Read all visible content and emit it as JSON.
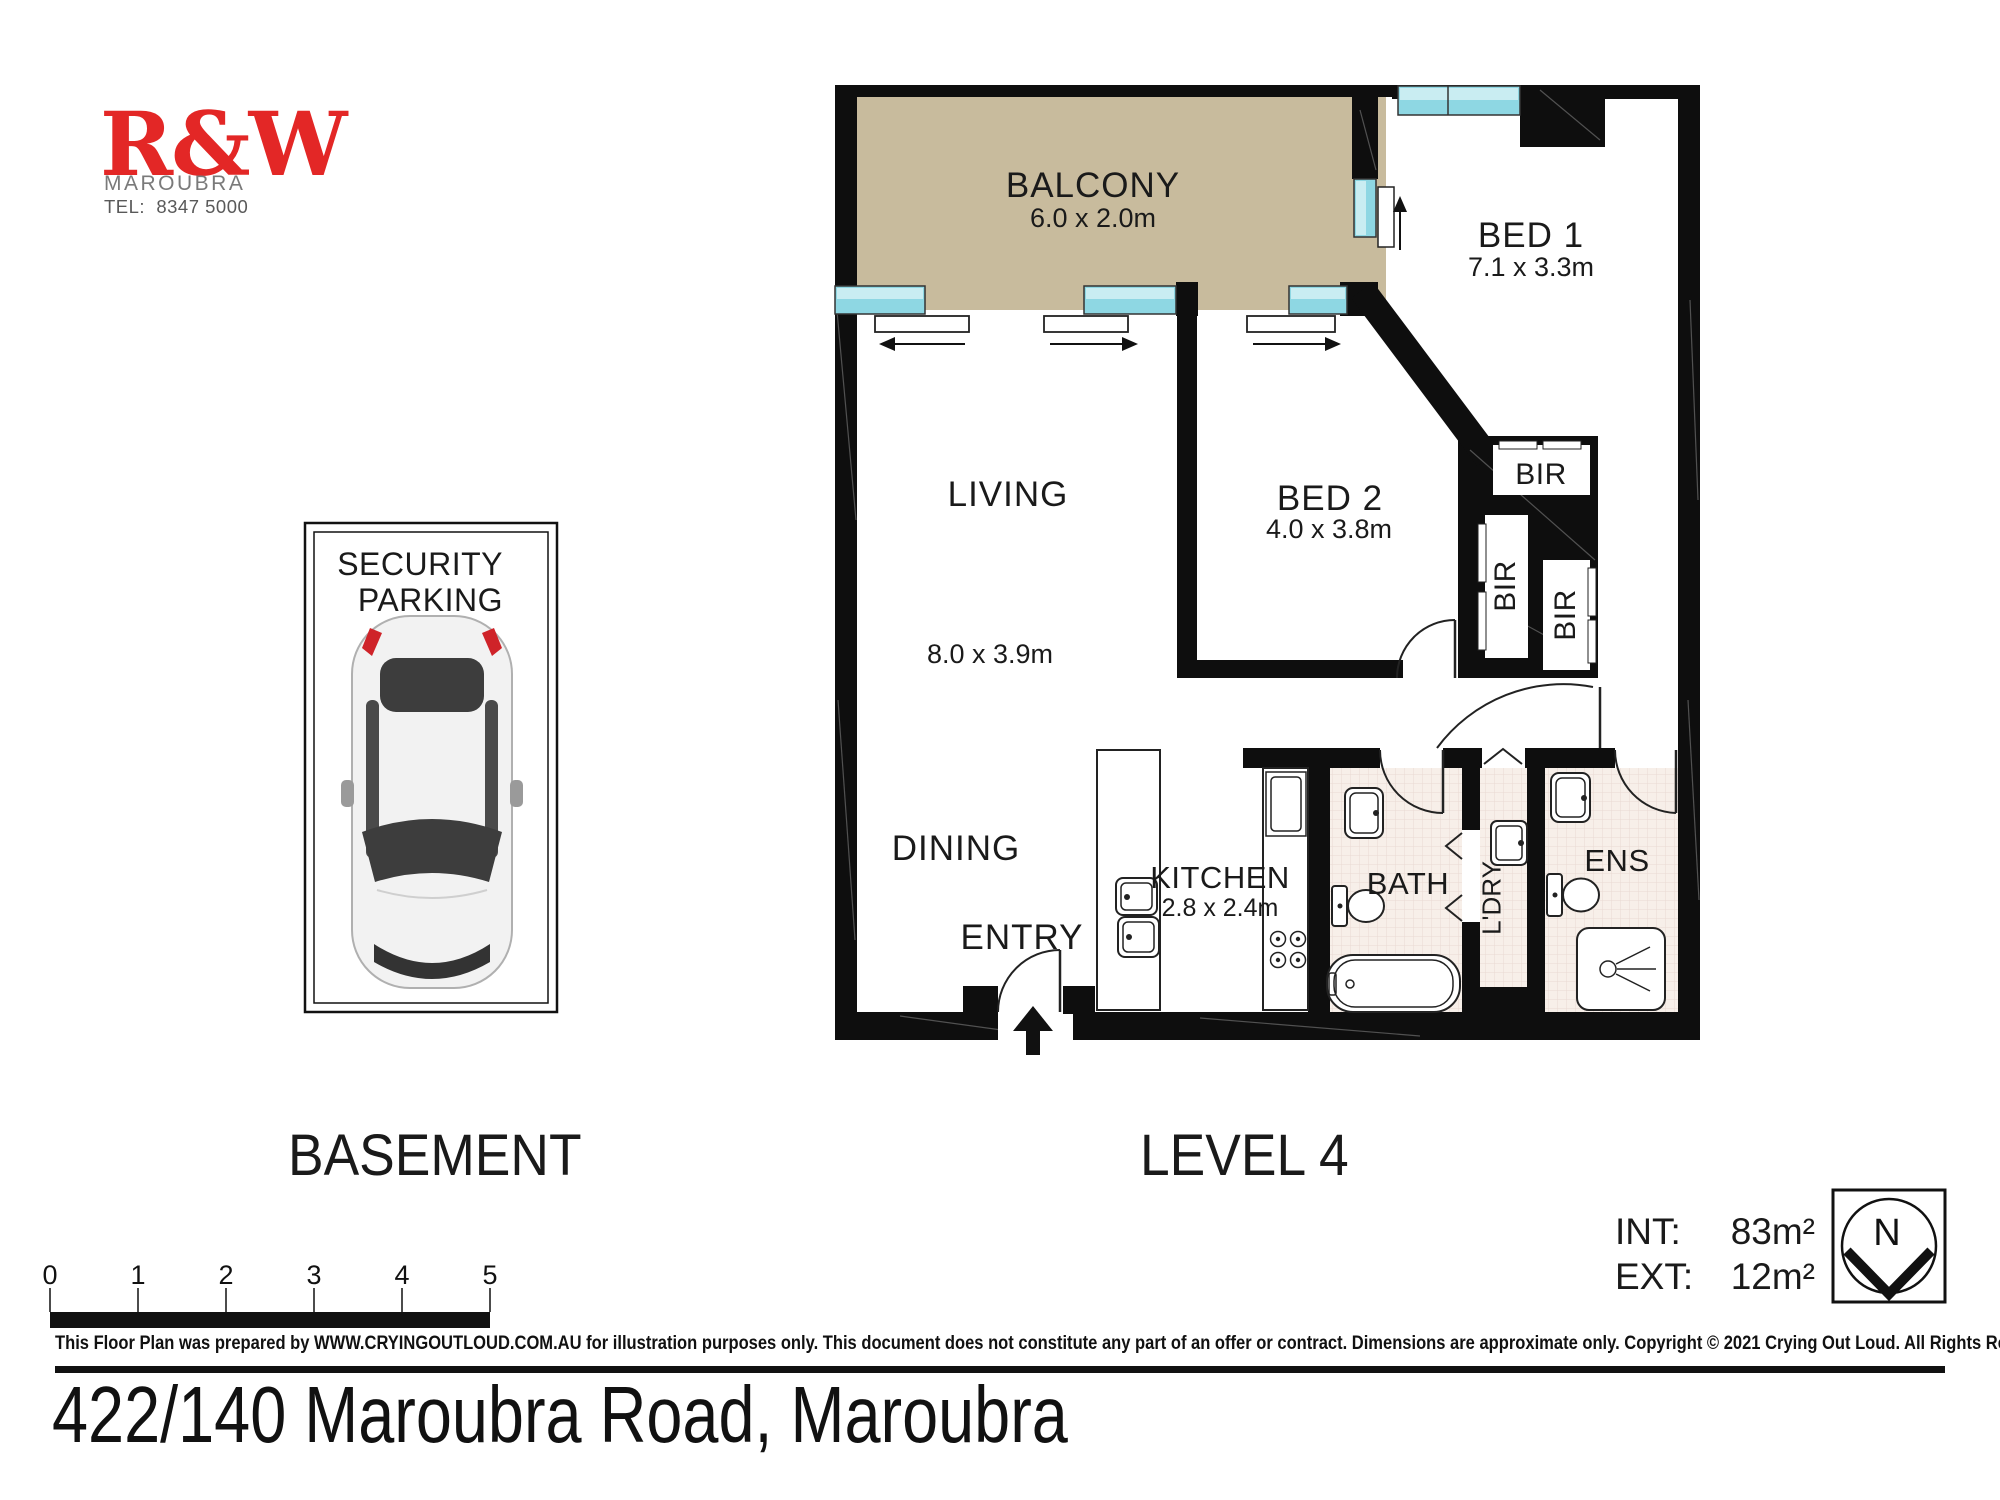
{
  "agency": {
    "name": "R&W",
    "suburb": "MAROUBRA",
    "phone": "TEL:  8347 5000"
  },
  "plan": {
    "rooms": {
      "balcony": {
        "name": "BALCONY",
        "dims": "6.0 x 2.0m"
      },
      "bed1": {
        "name": "BED 1",
        "dims": "7.1 x 3.3m"
      },
      "bed2": {
        "name": "BED 2",
        "dims": "4.0 x 3.8m"
      },
      "living": {
        "name": "LIVING",
        "dims": "8.0 x 3.9m"
      },
      "dining": {
        "name": "DINING"
      },
      "entry": {
        "name": "ENTRY"
      },
      "kitchen": {
        "name": "KITCHEN",
        "dims": "2.8 x 2.4m"
      },
      "bath": {
        "name": "BATH"
      },
      "laundry": {
        "name": "L'DRY"
      },
      "ensuite": {
        "name": "ENS"
      },
      "robe1": {
        "name": "BIR"
      },
      "robe2": {
        "name": "BIR"
      },
      "robe3": {
        "name": "BIR"
      }
    },
    "level_labels": {
      "basement": "BASEMENT",
      "level4": "LEVEL 4"
    },
    "parking": {
      "line1": "SECURITY",
      "line2": "PARKING"
    },
    "areas": {
      "int_label": "INT:",
      "int_value": "83m²",
      "ext_label": "EXT:",
      "ext_value": "12m²"
    },
    "compass": {
      "north": "N"
    },
    "scale_bar": {
      "ticks": [
        "0",
        "1",
        "2",
        "3",
        "4",
        "5"
      ]
    }
  },
  "footer": {
    "disclaimer": "This Floor Plan was prepared by WWW.CRYINGOUTLOUD.COM.AU for illustration purposes only. This document does not constitute any part of an offer or contract. Dimensions are approximate only. Copyright © 2021 Crying Out Loud. All Rights Reserved.",
    "address": "422/140 Maroubra Road, Maroubra"
  },
  "colors": {
    "logo_red": "#e32726",
    "wall_black": "#0e0e0e",
    "balcony_tan": "#c8bb9d",
    "window_cyan": "#8ed7e3",
    "tile_pink": "#f7efe9"
  }
}
